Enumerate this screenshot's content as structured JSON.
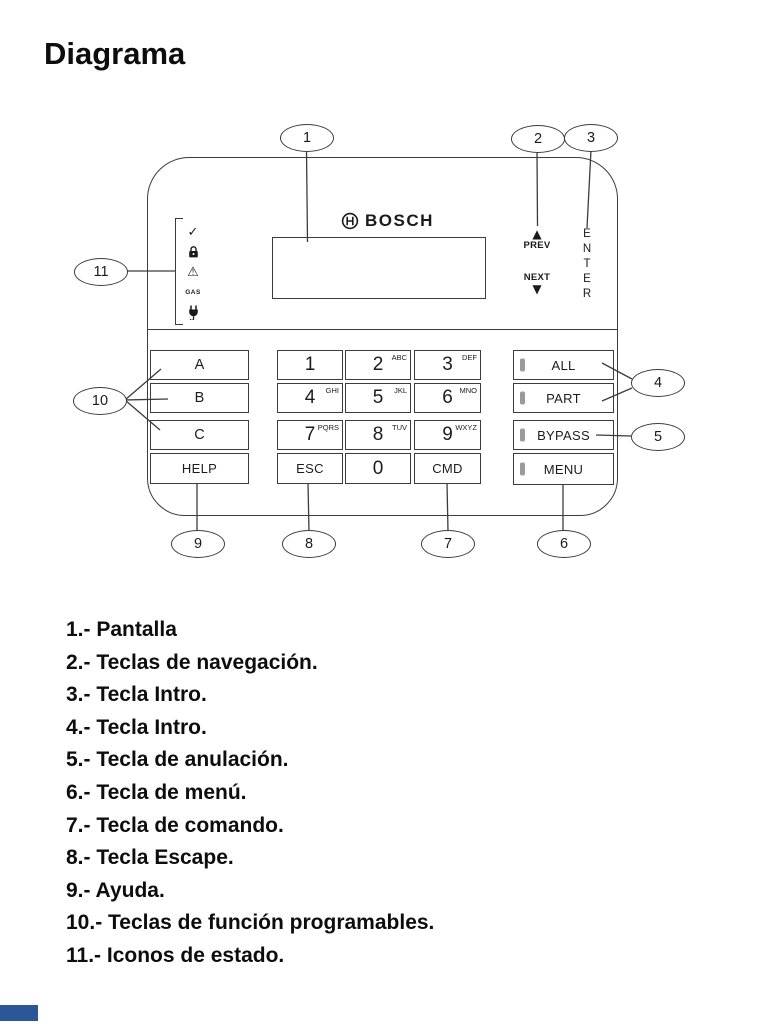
{
  "page": {
    "title": "Diagrama"
  },
  "colors": {
    "line": "#3c3c3c",
    "text": "#111111",
    "led": "#9a9a9a",
    "accent_bar": "#2b579a"
  },
  "icons": {
    "up_arrow": "▲",
    "down_arrow": "▼",
    "check": "✓",
    "warning": "⚠"
  },
  "keypad": {
    "brand": "BOSCH",
    "nav_prev": "PREV",
    "nav_next": "NEXT",
    "enter_label": "ENTER",
    "gas_label": "GAS",
    "function_keys": [
      {
        "label": "A"
      },
      {
        "label": "B"
      },
      {
        "label": "C"
      },
      {
        "label": "HELP"
      }
    ],
    "numpad": [
      {
        "label": "1",
        "sup": ""
      },
      {
        "label": "2",
        "sup": "ABC"
      },
      {
        "label": "3",
        "sup": "DEF"
      },
      {
        "label": "4",
        "sup": "GHI"
      },
      {
        "label": "5",
        "sup": "JKL"
      },
      {
        "label": "6",
        "sup": "MNO"
      },
      {
        "label": "7",
        "sup": "PQRS"
      },
      {
        "label": "8",
        "sup": "TUV"
      },
      {
        "label": "9",
        "sup": "WXYZ"
      },
      {
        "label": "ESC",
        "sup": ""
      },
      {
        "label": "0",
        "sup": ""
      },
      {
        "label": "CMD",
        "sup": ""
      }
    ],
    "right_keys": [
      {
        "label": "ALL"
      },
      {
        "label": "PART"
      },
      {
        "label": "BYPASS"
      },
      {
        "label": "MENU"
      }
    ]
  },
  "callouts": [
    "1",
    "2",
    "3",
    "4",
    "5",
    "6",
    "7",
    "8",
    "9",
    "10",
    "11"
  ],
  "legend": [
    "1.- Pantalla",
    "2.- Teclas de navegación.",
    "3.- Tecla Intro.",
    "4.- Tecla Intro.",
    "5.- Tecla de anulación.",
    "6.- Tecla de menú.",
    "7.- Tecla de comando.",
    "8.- Tecla Escape.",
    "9.- Ayuda.",
    "10.- Teclas de función programables.",
    "11.- Iconos de estado."
  ]
}
